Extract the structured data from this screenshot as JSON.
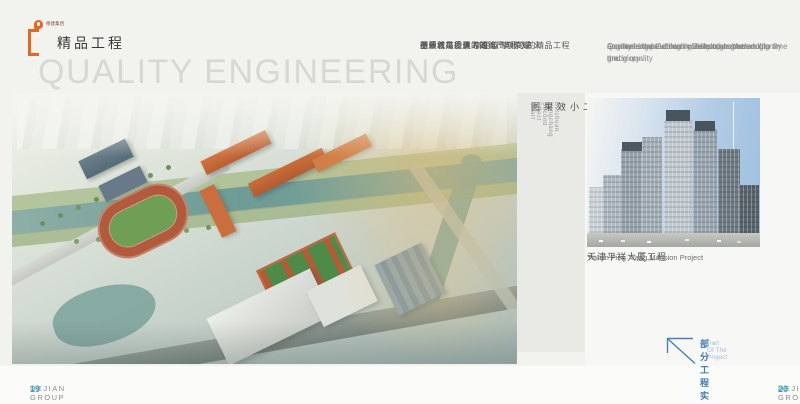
{
  "header": {
    "logo_text": "德建集团",
    "title": "精品工程",
    "watermark": "QUALITY ENGINEERING"
  },
  "intro_cn": {
    "lines": [
      "品质就是德建人的尊严与荣耀",
      "德建人以德信为魂  以时间的名义",
      "塑造着高质量  高品位  高档次的精品工程",
      "引领城市发展的潮流"
    ]
  },
  "intro_en": {
    "lines": [
      "Quality is the German construction human dignity   and glory",
      "German construction in Dickson as the soul to time the",
      "nominal shape of high quality  high grade  high-grade quality",
      "engineering   leads a city development trend"
    ]
  },
  "left_figure": {
    "caption_cn": "北川永昌二小效果图",
    "caption_en": "Beichuan Yongchang Second Effect Chart"
  },
  "right_figure": {
    "caption_cn": "天津平祥大厦工程",
    "caption_en": "Tianjin Ping Xiang Mansion Project"
  },
  "project_note": {
    "cn": "部分工程实例",
    "en": "Part Of The Project"
  },
  "footer": {
    "left_page_no": "19",
    "left_brand": "DEJIAN GROUP",
    "right_brand": "DEJIAN GROUP",
    "right_page_no": "20"
  },
  "colors": {
    "accent_orange": "#e8671c",
    "page_no_blue": "#2aa3d8",
    "note_blue": "#3d7ab5"
  }
}
